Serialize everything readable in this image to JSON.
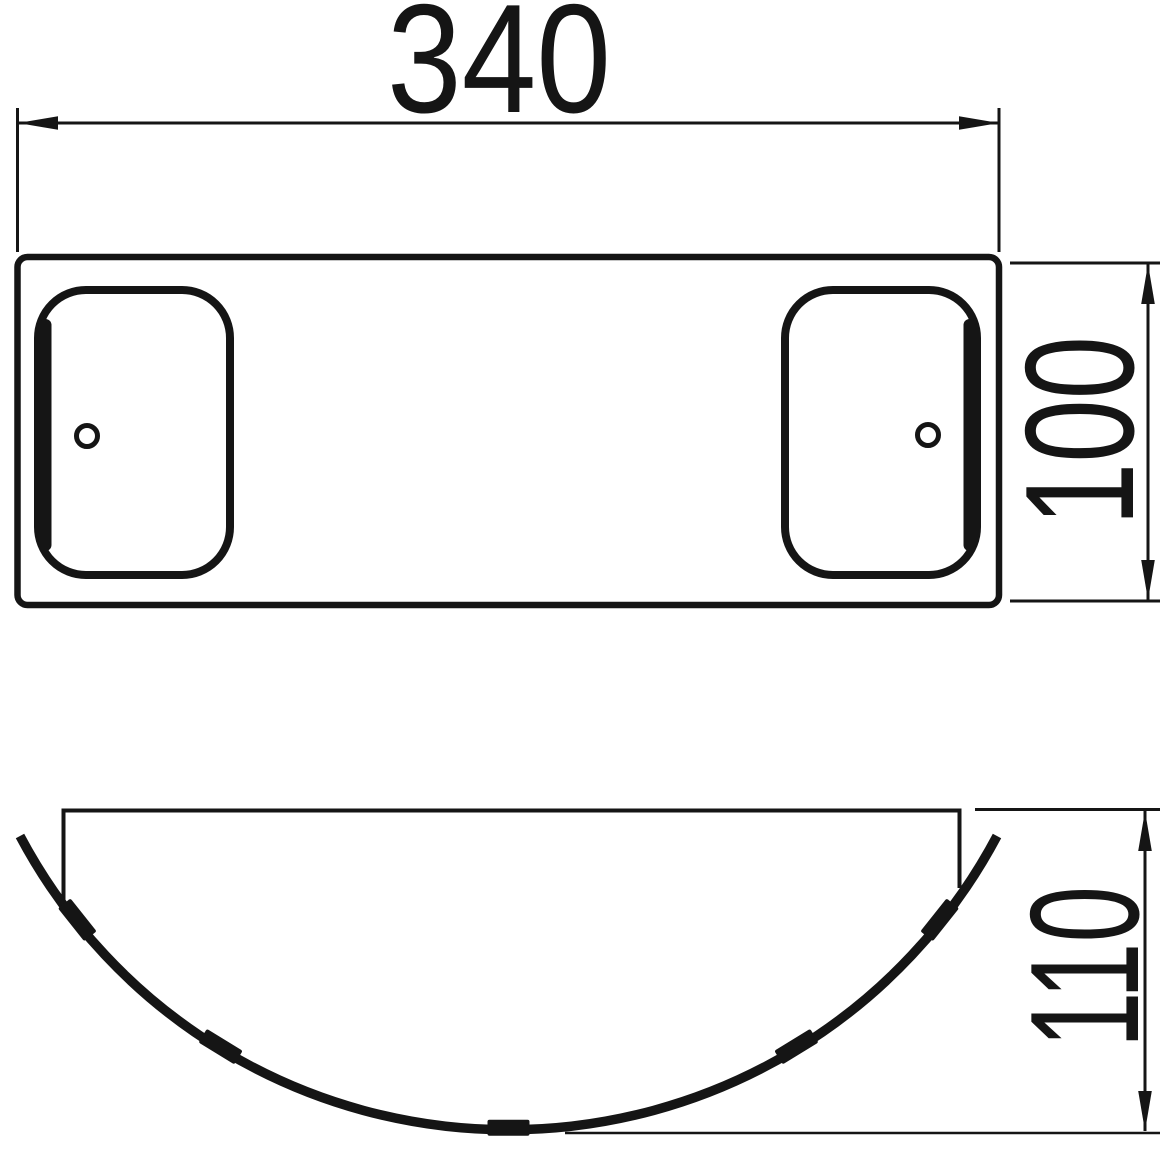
{
  "drawing": {
    "background_color": "#ffffff",
    "ink_color": "#151515",
    "dimensions": {
      "width": "340",
      "height": "100",
      "depth": "110"
    }
  }
}
